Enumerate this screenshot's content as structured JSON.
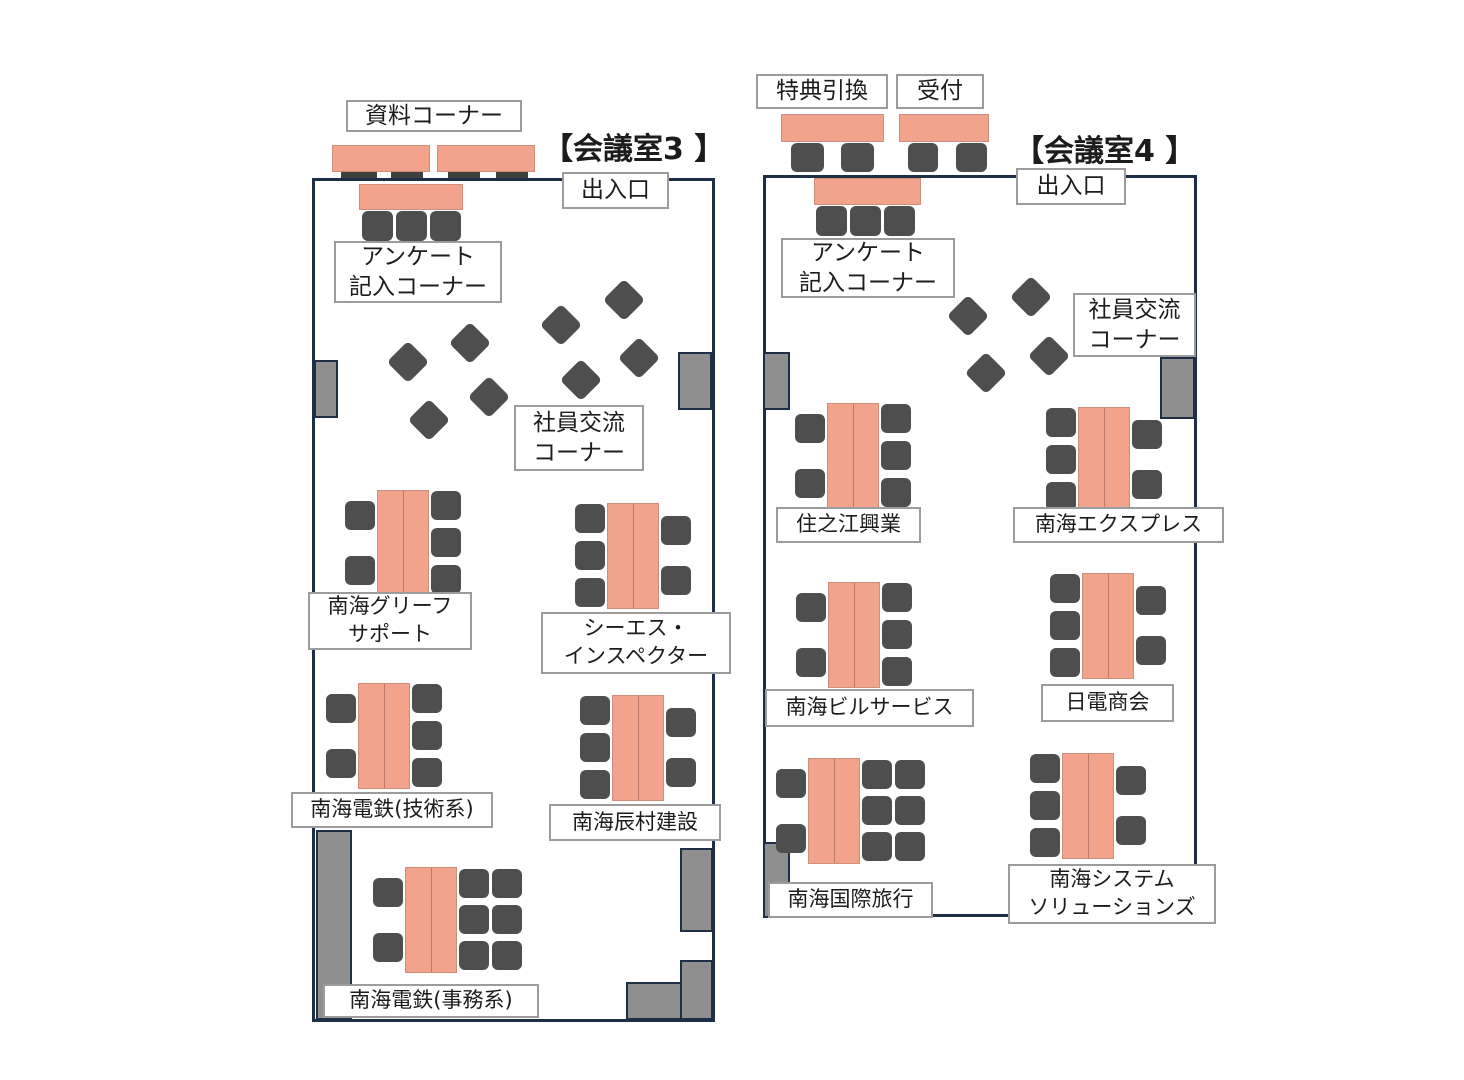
{
  "colors": {
    "wall": "#1e2f45",
    "table": "#f2a38c",
    "table_border": "#cf8d7a",
    "chair": "#4e4e4e",
    "pillar": "#8f8f8f",
    "label_border": "#9c9c9c",
    "text": "#1c1c1c"
  },
  "room3": {
    "title": "【会議室3 】",
    "entrance": "出入口",
    "labels": {
      "materials": "資料コーナー",
      "survey": [
        "アンケート",
        "記入コーナー"
      ],
      "exchange": [
        "社員交流",
        "コーナー"
      ]
    },
    "booths": [
      {
        "name": [
          "南海グリーフ",
          "サポート"
        ],
        "table": [
          377,
          490
        ],
        "left": 2,
        "right": 3,
        "label_box": [
          308,
          592,
          164,
          58
        ]
      },
      {
        "name": [
          "シーエス・",
          "インスペクター"
        ],
        "table": [
          607,
          503
        ],
        "left": 3,
        "right": 2,
        "label_box": [
          541,
          612,
          190,
          62
        ]
      },
      {
        "name": [
          "南海電鉄(技術系)"
        ],
        "table": [
          358,
          683
        ],
        "left": 2,
        "right": 3,
        "label_box": [
          291,
          792,
          202,
          36
        ]
      },
      {
        "name": [
          "南海辰村建設"
        ],
        "table": [
          612,
          695
        ],
        "left": 3,
        "right": 2,
        "label_box": [
          549,
          804,
          172,
          37
        ]
      },
      {
        "name": [
          "南海電鉄(事務系)"
        ],
        "table": [
          405,
          867
        ],
        "left": 2,
        "right": 6,
        "label_box": [
          323,
          984,
          216,
          34
        ]
      }
    ],
    "loose_chairs": [
      [
        624,
        300
      ],
      [
        561,
        325
      ],
      [
        470,
        343
      ],
      [
        639,
        358
      ],
      [
        408,
        362
      ],
      [
        581,
        380
      ],
      [
        489,
        397
      ],
      [
        429,
        420
      ]
    ]
  },
  "room4": {
    "title": "【会議室4 】",
    "entrance": "出入口",
    "labels": {
      "reward": "特典引換",
      "reception": "受付",
      "survey": [
        "アンケート",
        "記入コーナー"
      ],
      "exchange": [
        "社員交流",
        "コーナー"
      ]
    },
    "booths": [
      {
        "name": [
          "住之江興業"
        ],
        "table": [
          827,
          403
        ],
        "left": 2,
        "right": 3,
        "label_box": [
          776,
          507,
          145,
          36
        ]
      },
      {
        "name": [
          "南海エクスプレス"
        ],
        "table": [
          1078,
          407
        ],
        "left": 3,
        "right": 2,
        "label_box": [
          1013,
          507,
          211,
          36
        ]
      },
      {
        "name": [
          "南海ビルサービス"
        ],
        "table": [
          828,
          582
        ],
        "left": 2,
        "right": 3,
        "label_box": [
          765,
          689,
          209,
          38
        ]
      },
      {
        "name": [
          "日電商会"
        ],
        "table": [
          1082,
          573
        ],
        "left": 3,
        "right": 2,
        "label_box": [
          1041,
          684,
          133,
          38
        ]
      },
      {
        "name": [
          "南海国際旅行"
        ],
        "table": [
          808,
          758
        ],
        "left": 2,
        "right": 6,
        "label_box": [
          768,
          882,
          165,
          36
        ]
      },
      {
        "name": [
          "南海システム",
          "ソリューションズ"
        ],
        "table": [
          1062,
          753
        ],
        "left": 3,
        "right": 2,
        "label_box": [
          1008,
          864,
          208,
          60
        ]
      }
    ],
    "loose_chairs": [
      [
        1031,
        297
      ],
      [
        968,
        316
      ],
      [
        1049,
        356
      ],
      [
        986,
        373
      ]
    ]
  }
}
